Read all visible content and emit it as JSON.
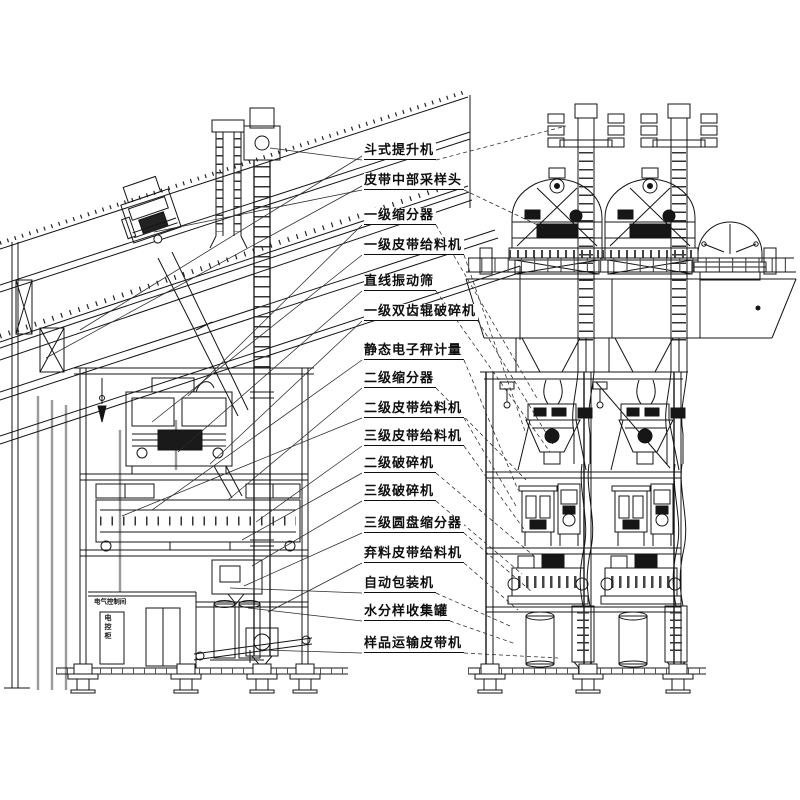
{
  "document": {
    "kind": "equipment-arrangement-drawing",
    "language": "zh-CN",
    "views": 2
  },
  "labels": [
    "斗式提升机",
    "皮带中部采样头",
    "一级缩分器",
    "一级皮带给料机",
    "直线振动筛",
    "一级双齿辊破碎机",
    "静态电子秤计量",
    "二级缩分器",
    "二级皮带给料机",
    "三级皮带给料机",
    "二级破碎机",
    "三级破碎机",
    "三级圆盘缩分器",
    "弃料皮带给料机",
    "自动包装机",
    "水分样收集罐",
    "样品运输皮带机"
  ],
  "room": {
    "label": "电气控制间",
    "label_vertical": "电控柜"
  },
  "colors": {
    "line": "#141414",
    "gray_column": "#999999",
    "background": "#ffffff"
  }
}
